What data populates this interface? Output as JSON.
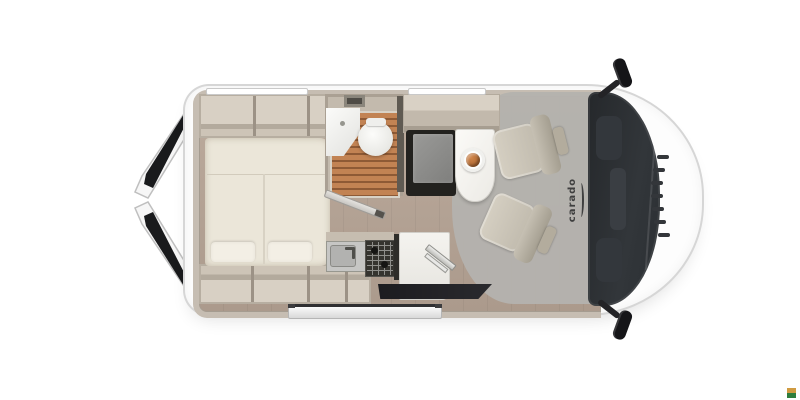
{
  "meta": {
    "description": "Top-down floor plan illustration of a Carado camper van with open rear doors, rear bed, bathroom, kitchen block, half-dinette with table and two swivelled cab seats"
  },
  "logo": {
    "text": "carado"
  },
  "palette": {
    "bg": "#ffffff",
    "shell": "#fdfdfd",
    "outline": "#d6d6d6",
    "wall": "#c6bdb2",
    "cab_face": "#cdc4b7",
    "cab_divider": "#9c9286",
    "bed": "#ebe6d9",
    "pillow": "#f3efe5",
    "floor": "#bcab9d",
    "mat": "#b4b2ae",
    "slat_a": "#c28353",
    "slat_b": "#8e5a35",
    "bench_frame": "#23221f",
    "seat": "#c1bbae",
    "seat_dark": "#a49e90",
    "ws": "#32363a",
    "dark": "#151518",
    "logo": "#3f3f3f",
    "step_dark": "#2f2f31",
    "wm_top": "#d09b41",
    "wm_green": "#2f7d3c"
  },
  "zones": [
    "open-rear-doors",
    "rear-bed",
    "overhead-cabinets",
    "bathroom",
    "shower-floor",
    "corner-sink",
    "toilet",
    "wardrobe-bench",
    "dining-table",
    "food-plate",
    "kitchen-sink",
    "gas-stove",
    "kitchen-counter",
    "sliding-door-opening",
    "entry-step",
    "swivel-seat-front",
    "swivel-seat-rear",
    "windshield",
    "front-grille",
    "left-mirror",
    "right-mirror",
    "carado-logo"
  ]
}
